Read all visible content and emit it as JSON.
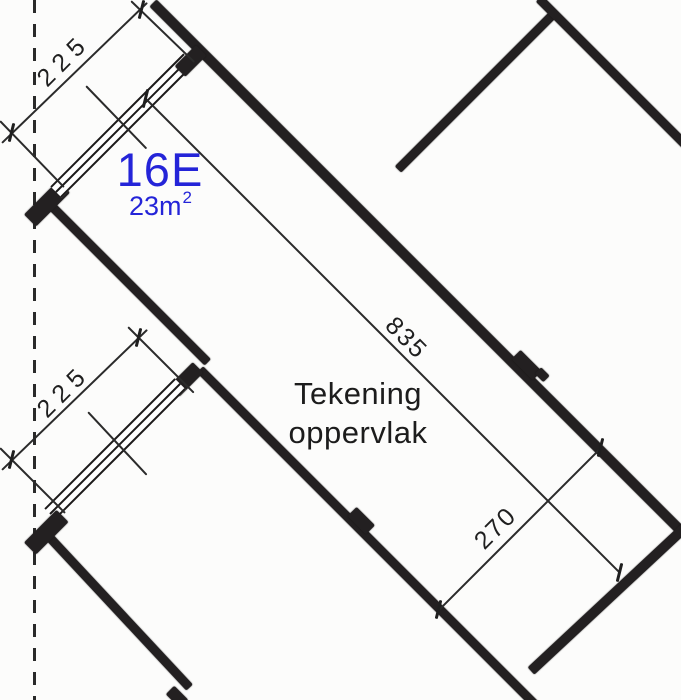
{
  "drawing": {
    "unit_label": "16E",
    "area_value": "23m",
    "area_sup": "2",
    "room_label_line1": "Tekening",
    "room_label_line2": "oppervlak",
    "dim_window_top": "225",
    "dim_window_bottom": "225",
    "dim_length": "835",
    "dim_width": "270"
  },
  "colors": {
    "accent_blue": "#2424d8",
    "wall_ink": "#232021",
    "line_ink": "#2b2b2b",
    "paper": "#fcfcfb"
  }
}
